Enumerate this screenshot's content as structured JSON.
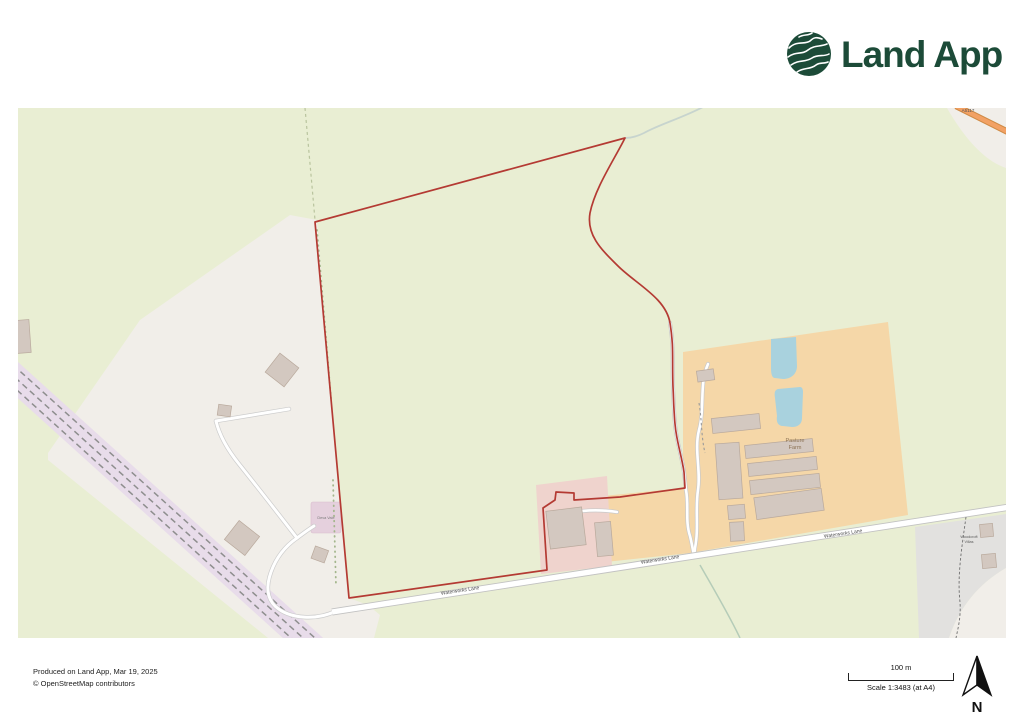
{
  "logo": {
    "text": "Land App",
    "brand_color": "#1c4b38"
  },
  "attribution": {
    "line1": "Produced on Land App, Mar 19, 2025",
    "line2": "© OpenStreetMap contributors"
  },
  "scalebar": {
    "distance": "100 m",
    "scale": "Scale 1:3483 (at A4)"
  },
  "compass": {
    "north": "N"
  },
  "map": {
    "labels": {
      "farm_line1": "Pasture",
      "farm_line2": "Farm",
      "road": "Waterworks Lane",
      "hamlet_line1": "Woodcroft",
      "hamlet_line2": "Villas",
      "site": "Deva Vale",
      "a_road": "A5117"
    },
    "colors": {
      "boundary_red": "#b43a33",
      "base_green": "#e9eed3",
      "land_beige": "#f1eee9",
      "farmyard_orange": "#f5d7a8",
      "commercial_pink": "#efd3cd",
      "residential_grey": "#e2e1df",
      "water_blue": "#a9d2de",
      "railway_lavender": "#e8dcea",
      "building_grey": "#d3c8c0",
      "a_road_orange": "#f2a164"
    }
  }
}
